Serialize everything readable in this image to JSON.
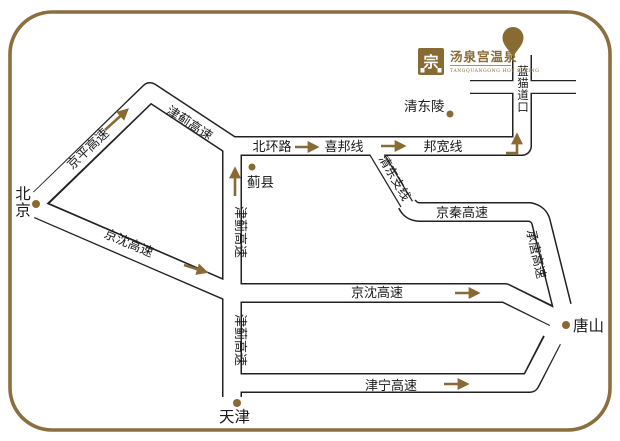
{
  "brand": {
    "seal_char": "宗",
    "name_cn": "汤泉宫温泉",
    "name_en": "TANGQUANGONG HOT SPRING"
  },
  "colors": {
    "accent_brown": "#8a6a33",
    "border_brown": "#8b6f3f",
    "road_casing_black": "#222222",
    "background": "#ffffff"
  },
  "cities": {
    "beijing": "北京",
    "tianjin": "天津",
    "tangshan": "唐山",
    "jixian": "蓟县",
    "qingdongling": "清东陵"
  },
  "roads": {
    "jingping": "京平高速",
    "jinji": "津蓟高速",
    "beihuan": "北环路",
    "xibang": "喜邦线",
    "bangkuan": "邦宽线",
    "qingdong_branch": "清东支线",
    "jingqin": "京秦高速",
    "chengtang": "承唐高速",
    "jingshen": "京沈高速",
    "jinning": "津宁高速",
    "lanmao_crossing": "蓝猫道口"
  }
}
